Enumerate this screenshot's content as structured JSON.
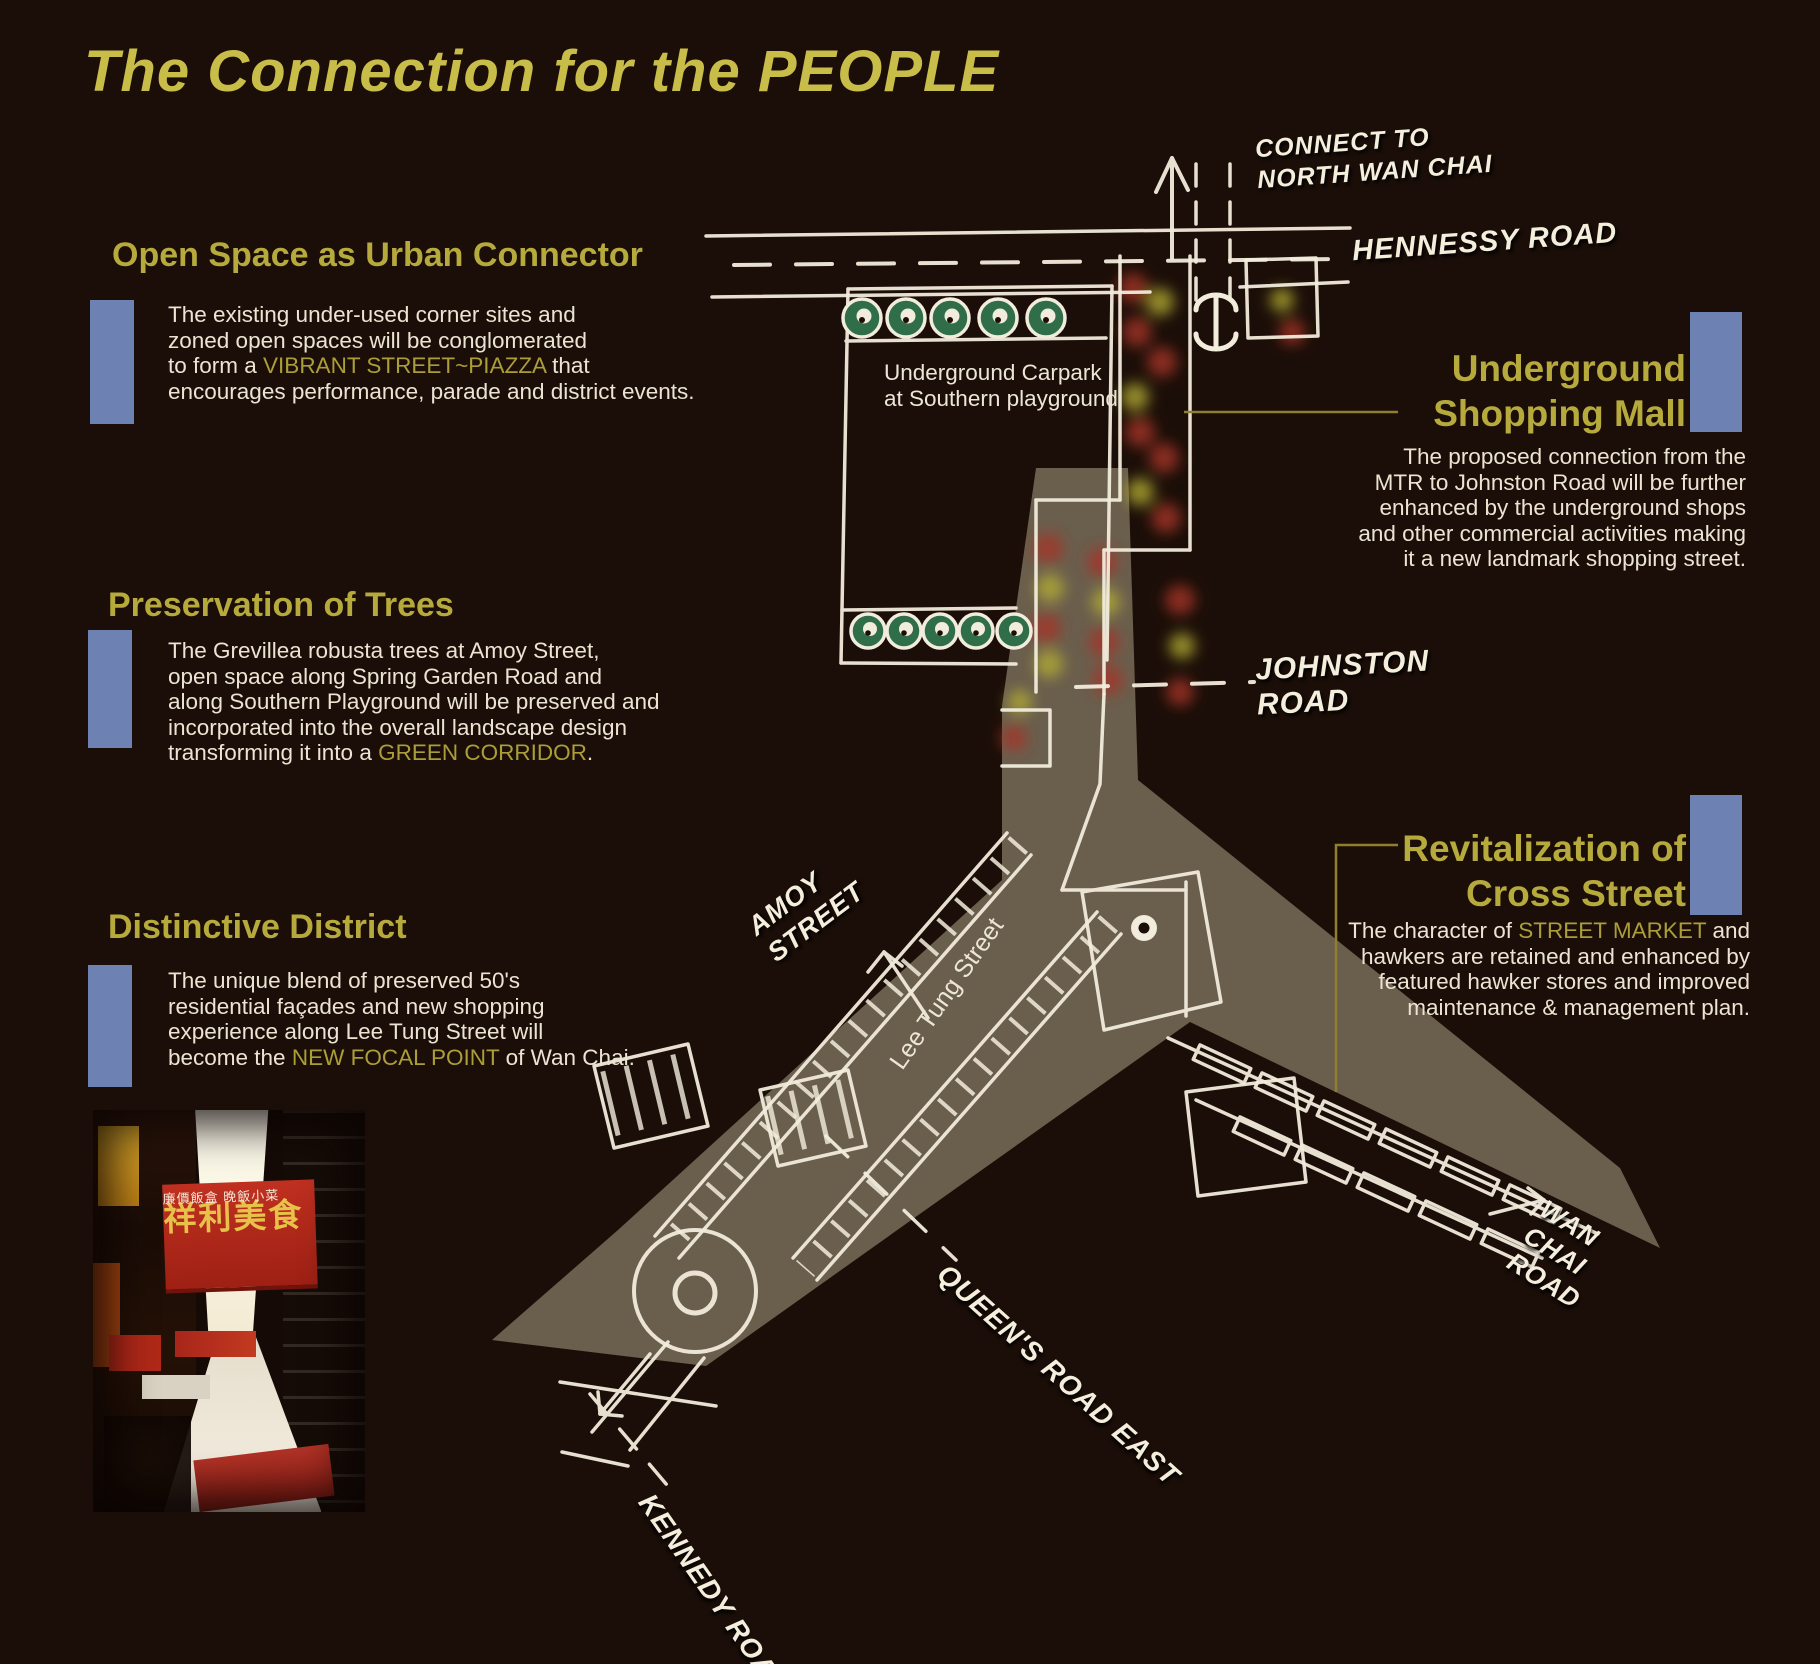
{
  "title": "The Connection for the PEOPLE",
  "sections": {
    "open_space": {
      "heading": "Open Space as Urban Connector",
      "body_pre": "The existing under-used corner sites and\nzoned open spaces will be conglomerated\nto form a ",
      "highlight": "VIBRANT STREET~PIAZZA",
      "body_post": " that\nencourages performance, parade and district events."
    },
    "preservation": {
      "heading": "Preservation of Trees",
      "body_pre": "The Grevillea robusta trees at Amoy Street,\nopen space along Spring Garden Road and\nalong Southern Playground will be preserved and\nincorporated into the overall landscape design\ntransforming it into a ",
      "highlight": "GREEN CORRIDOR",
      "body_post": "."
    },
    "distinctive": {
      "heading": "Distinctive District",
      "body_pre": "The unique blend of preserved 50's\nresidential façades and new shopping\nexperience along Lee Tung Street will\nbecome the ",
      "highlight": "NEW FOCAL POINT",
      "body_post": " of Wan Chai."
    },
    "underground": {
      "heading": "Underground\nShopping Mall",
      "body": "The proposed connection from the\nMTR to Johnston Road will be further\nenhanced by the underground shops\nand other commercial activities making\nit a new landmark shopping street."
    },
    "revitalization": {
      "heading": "Revitalization of\nCross Street",
      "body_pre": "The character of ",
      "highlight": "STREET MARKET",
      "body_post": " and\nhawkers are retained and enhanced by\nfeatured hawker stores and improved\nmaintenance & management plan."
    }
  },
  "map": {
    "labels": {
      "connect": "CONNECT TO\nNORTH WAN CHAI",
      "hennessy": "HENNESSY ROAD",
      "johnston": "JOHNSTON\nROAD",
      "carpark": "Underground Carpark\nat Southern playground",
      "amoy": "AMOY\nSTREET",
      "lee_tung": "Lee Tung Street",
      "queens": "QUEEN'S ROAD EAST",
      "kennedy": "KENNEDY ROAD",
      "wanchai": "WAN\nCHAI\nROAD"
    }
  },
  "photo": {
    "sign_main": "祥利美食",
    "sign_sub": "廉價飯盒 晚飯小菜"
  },
  "colors": {
    "background": "#1b0e08",
    "title_yellow": "#c9bd4a",
    "heading_yellow": "#b7aa3d",
    "body_cream": "#ebe4d2",
    "accent_blue": "#6d81b2",
    "map_line": "#f2ecdc",
    "street_band": "#cdc1a2",
    "tree_green": "#2f6e49",
    "mall_red": "#a63427",
    "mall_yellow": "#b4ad35",
    "leader_olive": "#8f7f2e"
  }
}
